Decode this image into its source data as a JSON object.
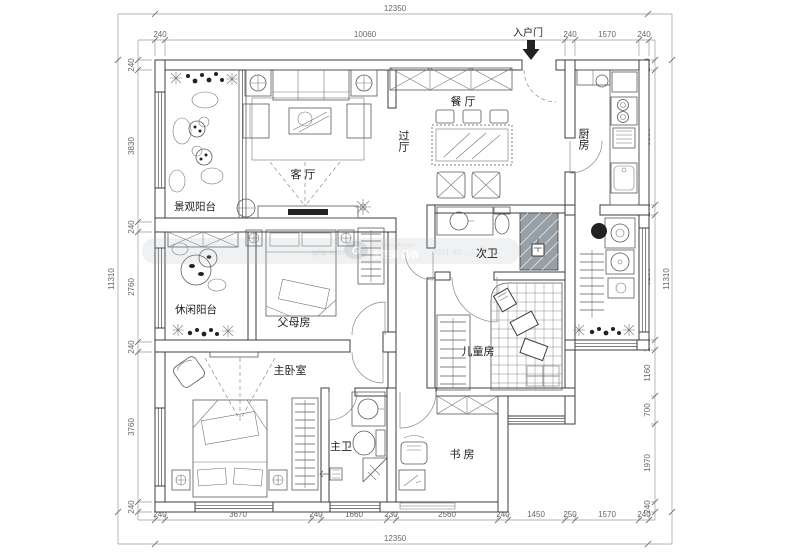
{
  "plan": {
    "title_note": "apartment floor plan",
    "rooms": {
      "living": "客 厅",
      "dining": "餐 厅",
      "hall": "过厅",
      "kitchen": "厨房",
      "view_balcony": "景观阳台",
      "leisure_balcony": "休闲阳台",
      "parents": "父母房",
      "second_bath": "次卫",
      "kids": "儿童房",
      "master": "主卧室",
      "master_bath": "主卫",
      "study": "书 房",
      "entry": "入户门"
    },
    "dims": {
      "top_total": "12350",
      "top": [
        "240",
        "10060",
        "240",
        "1570",
        "240"
      ],
      "bottom": [
        "240",
        "3670",
        "240",
        "1660",
        "230",
        "2560",
        "240",
        "1450",
        "250",
        "1570",
        "240"
      ],
      "bottom_total": "12350",
      "left": [
        "240",
        "3830",
        "240",
        "2760",
        "240",
        "3760",
        "240"
      ],
      "left_total": "11310",
      "right": [
        "240",
        "3380",
        "240",
        "3160",
        "240",
        "1160",
        "700",
        "1970",
        "240"
      ],
      "right_total": "11310"
    },
    "watermark": {
      "site": "…gzip.com",
      "logo": "G",
      "brand_en": "Golden Mango",
      "brand_cn": "金芒果 装饰",
      "phone": "0371-63……"
    }
  }
}
